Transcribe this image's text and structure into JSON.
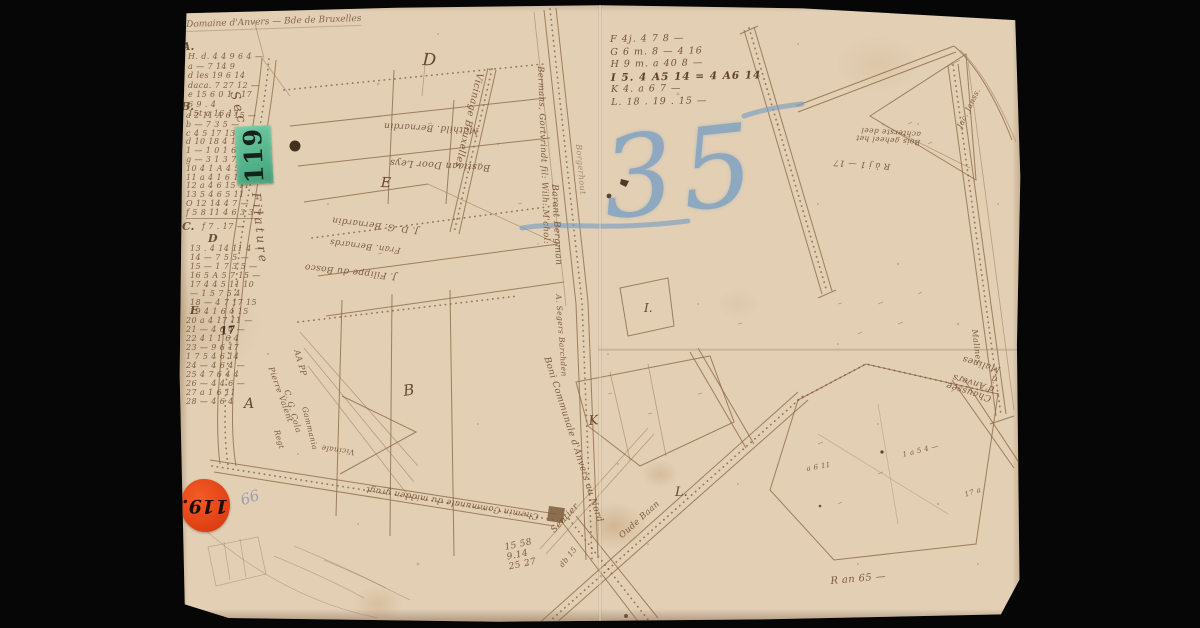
{
  "sheet": {
    "description": "Hand-drawn cadastral manuscript map, aged paper on black background",
    "colors": {
      "paper": "#e2cfb4",
      "ink": "#8d6946",
      "handwriting": "#6e4c2f",
      "green_sticker": "#4fae86",
      "red_sticker": "#dd3d12",
      "blue_crayon": "#7aa0c2",
      "pencil": "#8a94ad",
      "background": "#060606"
    }
  },
  "stickers": {
    "green": {
      "label": "119"
    },
    "red": {
      "label": "119."
    }
  },
  "crayon_number": {
    "text": "35"
  },
  "pencil_note": {
    "text": "66"
  },
  "header": {
    "text": "Domaine d'Anvers — Bde de Bruxelles"
  },
  "margin_index": {
    "mark": "17",
    "sections": [
      {
        "letter": "A.",
        "rows": [
          "H. d. 4 4 9 6 4 —",
          "a — 7 14 9",
          "d les 19 6 14",
          "daca. 7 27 12 —",
          "e 15 6 0 1 . 17",
          "6 9 . 4",
          "15t a 16 17"
        ]
      },
      {
        "letter": "B.",
        "rows": [
          "a 2 11 A 6 15 —",
          "b — 7 3 5 —",
          "c 4 5 17 13",
          "d 10 18 4 14",
          "1 — 1 0 1 6 —",
          "g — 3 1 3 7",
          "10 4 1 A 4 5 11",
          "11 a 4 1 6 11",
          "12 a 4 6 15 11",
          "13 5 4 6 5 11",
          "O 12 14 4 7 —",
          "f 5 8 11  4 6 3 3 4"
        ]
      },
      {
        "letter": "C.",
        "rows": [
          "f  7 . 17 —"
        ]
      },
      {
        "letter": "D",
        "rows": [
          "13 . 4 14 11 4 —",
          "14 — 7 5 5 —",
          "15 — 1 7 3 5 —",
          "16 5 A 5 7 15 —",
          "17 4 4 5 11 10",
          "— 1 5 7 5 4",
          "18 — 4 7 17 15",
          "19 4 1 6 4 15"
        ]
      },
      {
        "letter": "E",
        "rows": [
          "20 a 4 17 11 —",
          "21 — 4 6 4 —",
          "22 4 1 1 6 4",
          "23 — 9 6 17",
          "1 7 5 4 6 14",
          "24 — 4 6 4 —",
          "25 4 7 6 4 4",
          "26 — 4 4 6 —",
          "27 a 1 6 11",
          "28 — 4 6 4"
        ]
      }
    ]
  },
  "legend_list": {
    "rows": [
      "F 4j. 4 7 8 —",
      "G 6 m. 8 — 4 16",
      "H 9 m. a 40 8 —",
      "I 5. 4 A5 14 = 4 A6 14",
      "K 4. a 6 7 —",
      "L. 18 . 19 . 15 —"
    ]
  },
  "parcel_letters": [
    {
      "text": "A"
    },
    {
      "text": "B"
    },
    {
      "text": "D"
    },
    {
      "text": "E"
    },
    {
      "text": "I."
    },
    {
      "text": "K"
    },
    {
      "text": "L."
    }
  ],
  "map_labels": [
    {
      "text": "Section"
    },
    {
      "text": "Filature"
    },
    {
      "text": "Vicinage Bruxelles"
    },
    {
      "text": "Mathild. Bernardin"
    },
    {
      "text": "Bastiaan Door Leys"
    },
    {
      "text": "J. D. G. Bernardin"
    },
    {
      "text": "Fran. Bernards"
    },
    {
      "text": "J. Filippe du Bosco"
    },
    {
      "text": "Bermans, Gortvrindt fil: Wilh: M'chol:"
    },
    {
      "text": "Barent Bergman"
    },
    {
      "text": "Borgerhout"
    },
    {
      "text": "A. Segers Barchden"
    },
    {
      "text": "Boni Communale d'Anvers au Nord"
    },
    {
      "text": "Chemin Communale du midden gragt"
    },
    {
      "text": "Sentier"
    },
    {
      "text": "Oude Baan"
    },
    {
      "text": "Chaussée d'Anvers à Malines"
    },
    {
      "text": "Bois geheel het achterste deel"
    },
    {
      "text": "R à j 1 — 17"
    },
    {
      "text": "Jac. Janss."
    },
    {
      "text": "Malines"
    },
    {
      "text": "AA PP"
    },
    {
      "text": "Pierre Valent"
    },
    {
      "text": "C. G. Cola"
    },
    {
      "text": "Gammania"
    },
    {
      "text": "Regt"
    },
    {
      "text": "Vicinale"
    },
    {
      "text": "15 58\n9.14\n25 27"
    },
    {
      "text": "R an 65 —"
    },
    {
      "text": "db 15"
    },
    {
      "text": "1 a 5 4 —"
    },
    {
      "text": "17 a"
    },
    {
      "text": "a 6 11"
    }
  ]
}
